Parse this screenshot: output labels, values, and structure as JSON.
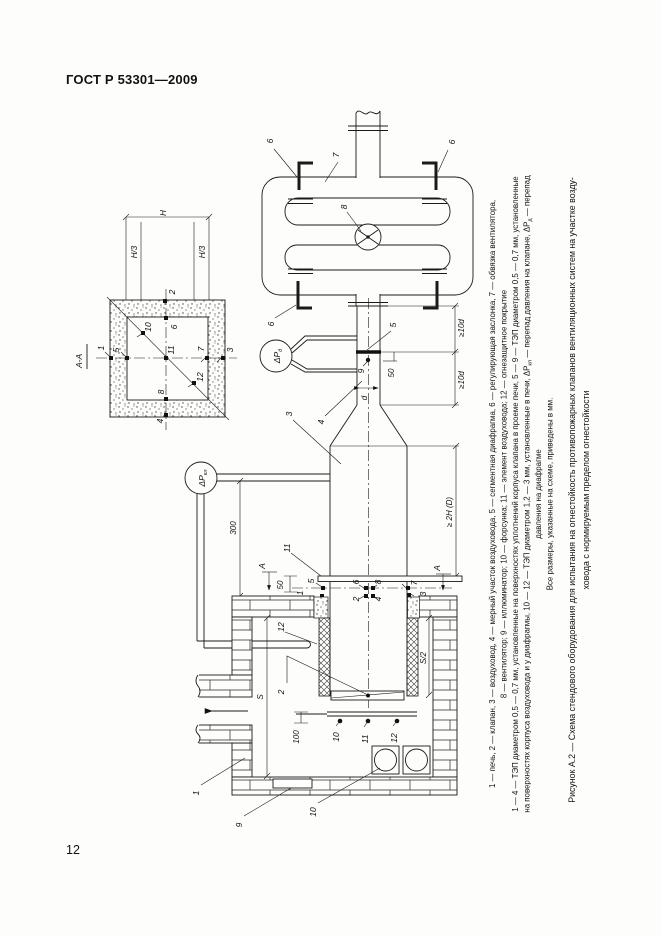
{
  "page": {
    "header": "ГОСТ Р 53301—2009",
    "page_number": "12"
  },
  "diagram": {
    "num": {
      "1": "1",
      "2": "2",
      "3": "3",
      "4": "4",
      "5": "5",
      "6": "6",
      "7": "7",
      "8": "8",
      "9": "9",
      "10": "10",
      "11": "11",
      "12": "12"
    },
    "dims": {
      "section_title": "А-А",
      "H": "Н",
      "H3": "Н/3",
      "d": "d",
      "ge10d": "≥10d",
      "ge2HD": "≥ 2H (D)",
      "n50": "50",
      "n100": "100",
      "n300": "300",
      "S": "S",
      "S2": "S/2",
      "A": "А"
    },
    "gauge_valve": {
      "main": "ΔР",
      "sub": "кл"
    },
    "gauge_diaphragm": {
      "main": "ΔР",
      "sub": "д"
    }
  },
  "figure": {
    "legend_line1": "1 — печь, 2 — клапан, 3 — воздуховод, 4 — мерный участок воздуховода, 5 — сегментная диафрагма, 6 — регулирующая заслонка, 7 — обвязка вентилятора,",
    "legend_line2": "8 — вентилятор; 9 — иллюминатор; 10 — форсунка; 11 — элемент воздуховода; 12 — огнезащитное покрытие",
    "legend_line3": "1 — 4 — ТЭП диаметром 0,5 — 0,7 мм, установленные на поверхностях уплотнений корпуса клапана в проеме печи, 5 — 9 — ТЭП диаметром 0,5 — 0,7 мм, установленные",
    "legend_line4": {
      "p0": "на поверхностях корпуса воздуховода и у диафрагмы, 10 — 12 — ТЭП диаметром 1,2 — 3 мм, установленные в печи, ΔР",
      "p1": "кл",
      "p2": " — перепад давления на клапане, ΔР",
      "p3": "д",
      "p4": " — перепад"
    },
    "legend_line5": "давления на диафрагме",
    "note": "Все размеры, указанные на схеме, приведены в мм.",
    "caption_line1": "Рисунок А.2 — Схема стендового оборудования для испытания на огнестойкость противопожарных клапанов вентиляционных систем на участке возду-",
    "caption_line2": "ховода с нормируемым пределом огнестойкости"
  }
}
